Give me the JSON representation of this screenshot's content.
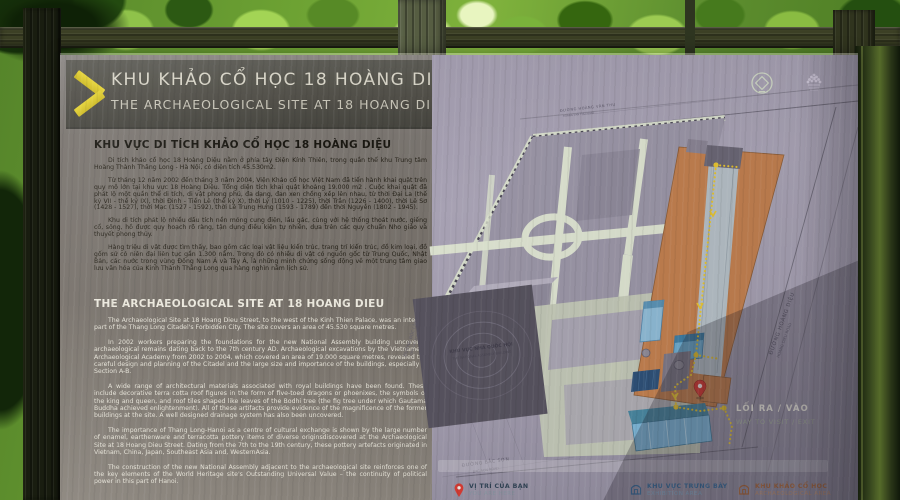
{
  "sign": {
    "header": {
      "title_vi": "KHU KHẢO CỔ HỌC 18 HOÀNG DIỆU",
      "title_en": "THE ARCHAEOLOGICAL SITE AT 18 HOANG DIEU"
    },
    "vi": {
      "heading": "KHU VỰC DI TÍCH KHẢO CỔ HỌC 18 HOÀNG DIỆU",
      "p": [
        "Di tích khảo cổ học 18 Hoàng Diệu nằm ở phía tây Điện Kính Thiên, trong quần thể khu Trung tâm Hoàng Thành Thăng Long - Hà Nội, có diện tích 45.530m2.",
        "Từ tháng 12 năm 2002 đến tháng 3 năm 2004, Viện Khảo cổ học Việt Nam đã tiến hành khai quật trên quy mô lớn tại khu vực 18 Hoàng Diệu. Tổng diện tích khai quật khoảng 19.000 m2 . Cuộc khai quật đã phát lộ một quần thể di tích, di vật phong phú, đa dạng, đan xen chồng xếp lên nhau, từ thời Đại La (thế kỷ VII - thế kỷ IX), thời Đinh - Tiền Lê (thế kỷ X), thời Lý (1010 - 1225), thời Trần (1226 - 1400), thời Lê Sơ (1428 - 1527), thời Mạc (1527 - 1592), thời Lê Trung Hưng (1593 - 1789) đến thời Nguyễn (1802 - 1945).",
        "Khu di tích phát lộ nhiều dấu tích nền móng cung điện, lầu gác, cùng với hệ thống thoát nước, giếng cổ, sông, hồ được quy hoạch rõ ràng, tận dụng điều kiện tự nhiên, dựa trên các quy chuẩn Nho giáo và thuyết phong thủy.",
        "Hàng triệu di vật được tìm thấy, bao gồm các loại vật liệu kiến trúc, trang trí kiến trúc, đồ kim loại, đồ gốm sứ có niên đại liên tục gần 1.300 năm. Trong đó có nhiều di vật có nguồn gốc từ Trung Quốc, Nhật Bản, các nước trong vùng Đông Nam Á và Tây Á, là những minh chứng sống động về một trung tâm giao lưu văn hóa của Kinh Thành Thăng Long qua hàng nghìn năm lịch sử."
      ]
    },
    "en": {
      "heading": "THE ARCHAEOLOGICAL SITE AT 18 HOANG DIEU",
      "p": [
        "The Archaeological Site at 18 Hoang Dieu Street, to the west of the Kinh Thien Palace, was an integral part of the Thang Long Citadel's Forbidden City. The site covers an area of 45.530 square metres.",
        "In 2002 workers preparing the foundations for the new National Assembly building uncovered archaeological remains dating back to the 7th century AD.  Archaeological excavations by the Vietnamese Archaeological Academy from 2002 to 2004, which covered an area of 19.000 square metres, revealed the careful design and planning of the Citadel and the large size and importance of the buildings, especially in Section A-B.",
        "A wide range of architectural materials associated with royal buildings have been found.  These include decorative terra cotta roof figures in the form of five-toed dragons or phoenixes, the symbols of the king and queen, and roof tiles shaped like leaves of the Bodhi tree (the fig tree under which Gautama Buddha achieved enlightenment). All of these artifacts provide evidence of the magnificence of the former buildings at the site.  A well designed drainage system has also been uncovered.",
        "The importance of Thang Long-Hanoi as a centre of cultural exchange is shown by the large number of enamel, earthenware and terracotta pottery items of diverse originsdiscovered at the Archaeological Site at 18 Hoang Dieu Street. Dating from the 7th to the 19th century, these pottery artefacts originated in Vietnam, China, Japan, Southeast Asia and, WesternAsia.",
        "The construction of the new National Assembly adjacent to the archaeological site reinforces one of the key elements of the World Heritage site's Outstanding Universal Value – the continuity of political power in this part of Hanoi."
      ]
    }
  },
  "map": {
    "assembly": {
      "vi": "KHU VỰC NHÀ QUỐC HỘI",
      "en": "THE NATIONAL ASSEMBLY BUILDING"
    },
    "streets": {
      "top": {
        "vi": "ĐƯỜNG HOÀNG VĂN THỤ",
        "en": "HOANG VAN THU ROAD"
      },
      "right": {
        "vi": "ĐƯỜNG HOÀNG DIỆU",
        "en": "HOANG DIEU ROAD"
      },
      "bottom": {
        "vi": "ĐƯỜNG BẮC SƠN",
        "en": "BAC SON ROAD"
      },
      "left": {
        "vi": "ĐƯỜNG ĐỘC LẬP",
        "en": "DOC LAP ROAD"
      }
    },
    "exit": {
      "vi": "LỐI RA / VÀO",
      "en": "WAY TO VISIT / EXIT"
    },
    "legend": [
      {
        "icon": "red-pin",
        "vi": "VỊ TRÍ CỦA BẠN",
        "en": "YOU ARE HERE"
      },
      {
        "icon": "blue-house",
        "vi": "KHU VỰC TRƯNG BÀY",
        "en": "EXHIBITION AREA"
      },
      {
        "icon": "orange-house",
        "vi": "KHU KHẢO CỔ HỌC",
        "en": "ARCHAEOLOGICAL AREA"
      }
    ]
  },
  "icons": {
    "chevron-right-icon": "thick yellow angle bracket",
    "world-heritage-emblem-icon": "circle enclosing diamond",
    "thang-long-emblem-icon": "dotted pagoda emblem",
    "location-pin-icon": "red map pin",
    "exhibition-house-icon": "blue pavilion outline",
    "archaeology-house-icon": "orange pavilion outline"
  },
  "colors": {
    "accent_yellow": "#dcc92e",
    "excavation_orange": "#c28050",
    "exhibition_blue": "#7cb5d6",
    "pin_red": "#d63c34",
    "map_lavender": "#a8a2b3",
    "board_gray": "#7e7974"
  }
}
